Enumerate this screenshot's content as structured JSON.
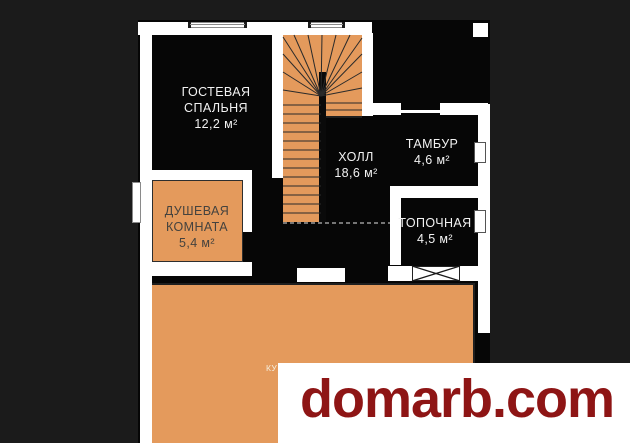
{
  "page": {
    "background": "#1b1b1b"
  },
  "plan": {
    "wall_color": "#ffffff",
    "room_fill": "#060606",
    "accent_orange": "#e49a5c",
    "rooms": {
      "guest_bedroom": {
        "name_line1": "ГОСТЕВАЯ",
        "name_line2": "СПАЛЬНЯ",
        "area": "12,2 м²"
      },
      "shower_room": {
        "name_line1": "ДУШЕВАЯ",
        "name_line2": "КОМНАТА",
        "area": "5,4 м²"
      },
      "hall": {
        "name": "ХОЛЛ",
        "area": "18,6 м²"
      },
      "tambour": {
        "name": "ТАМБУР",
        "area": "4,6 м²"
      },
      "boiler_room": {
        "name": "ТОПОЧНАЯ",
        "area": "4,5 м²"
      },
      "kitchen": {
        "visible_fragment": "КУ"
      }
    }
  },
  "watermark": {
    "text": "domarb.com",
    "text_color": "#8e1515",
    "background": "#ffffff"
  }
}
